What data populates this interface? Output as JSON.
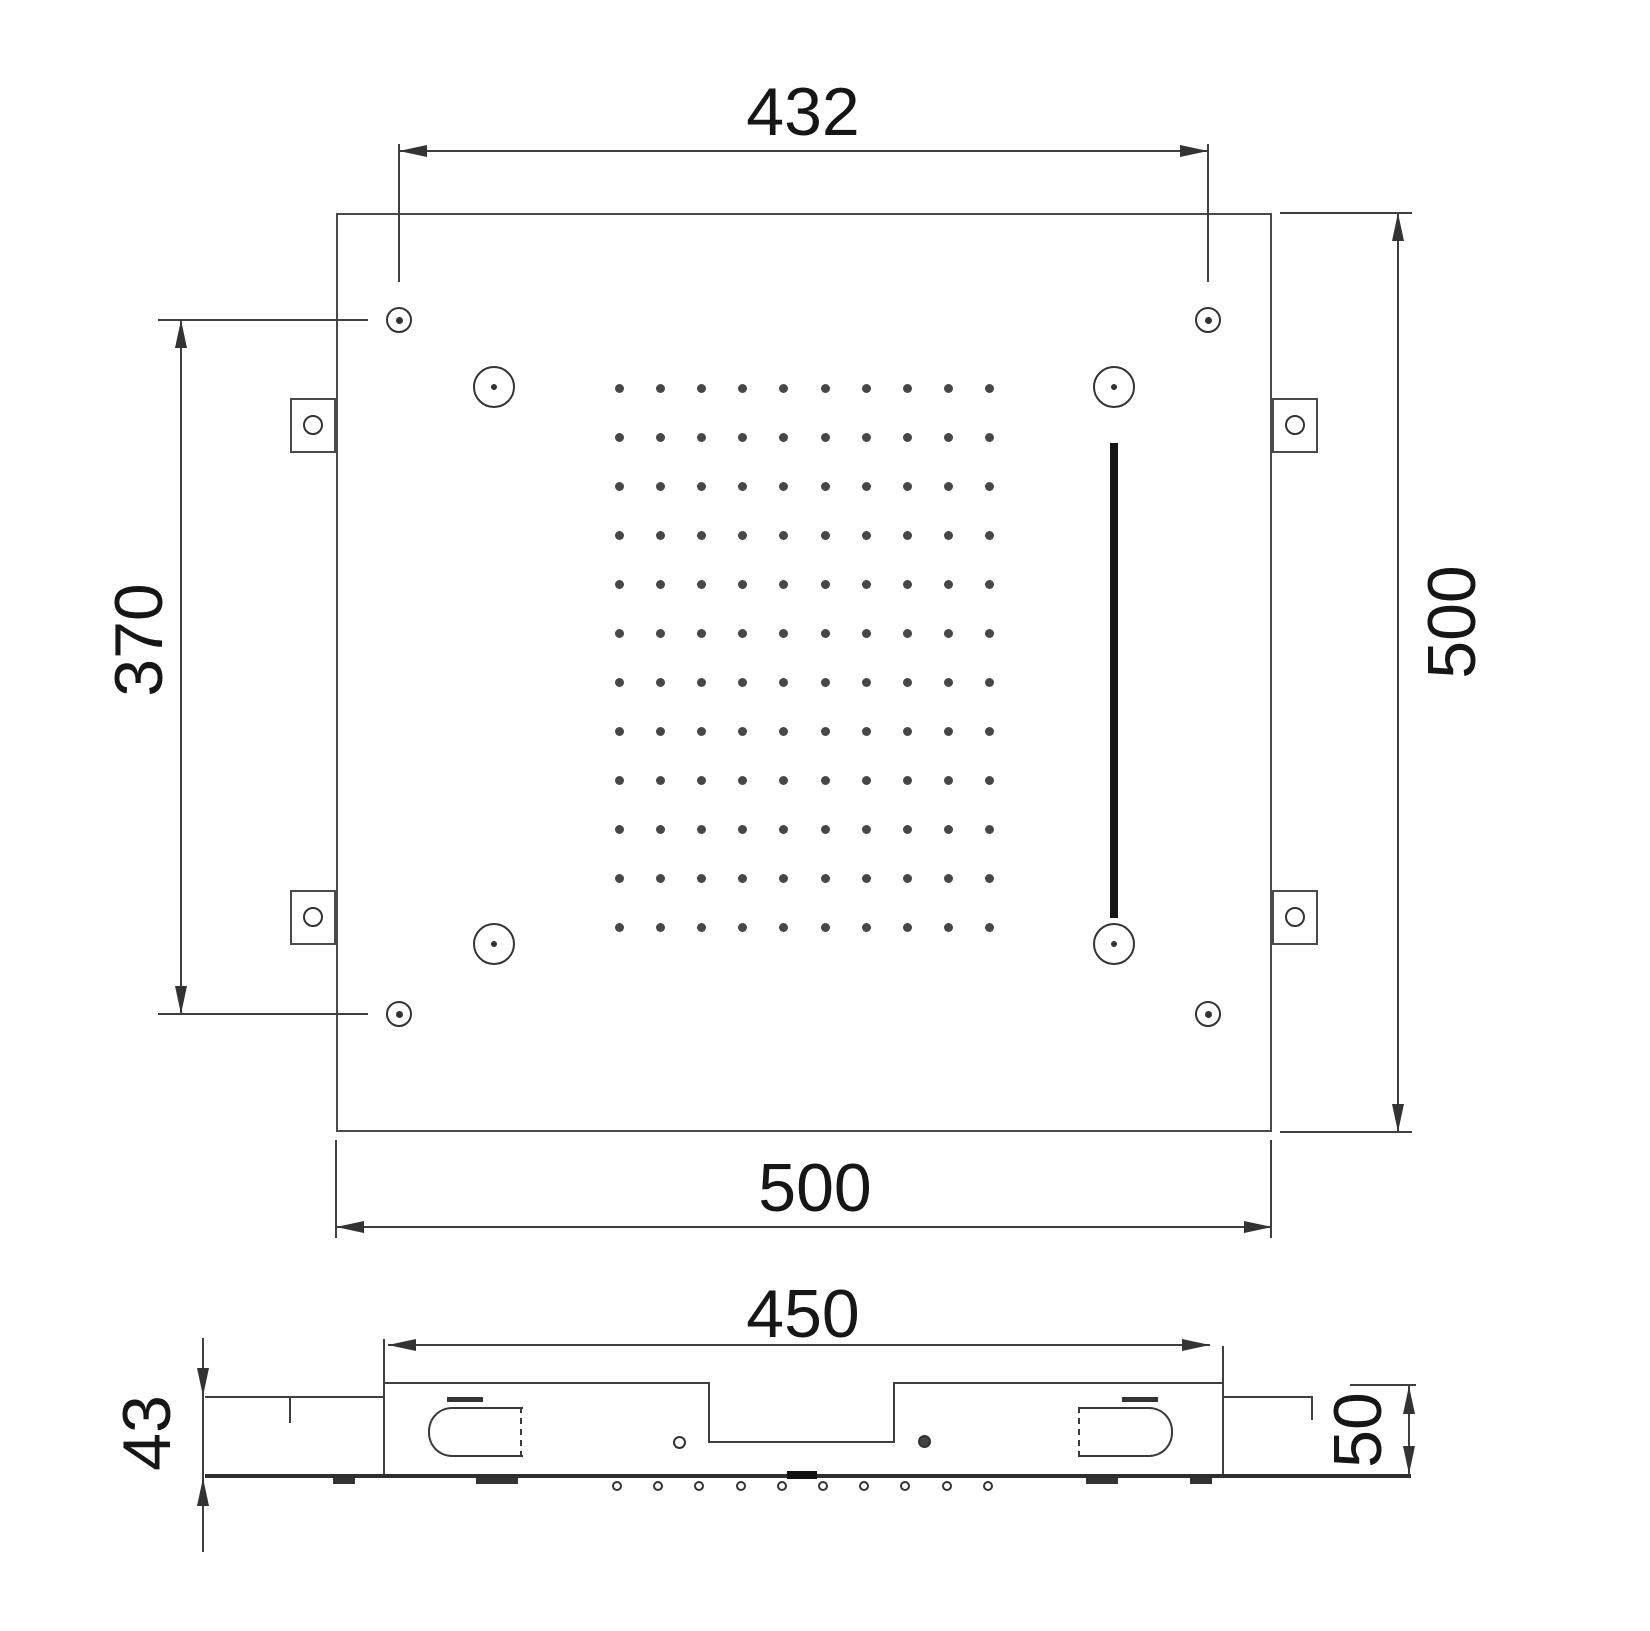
{
  "labels": {
    "plan_top_width": "432",
    "plan_left_height": "370",
    "plan_right_height": "500",
    "plan_bottom_width": "500",
    "section_width": "450",
    "section_left_depth": "43",
    "section_right_depth": "50"
  },
  "spray_grid": {
    "cols": 10,
    "rows": 12,
    "start_x": 619,
    "start_y": 388,
    "step_x": 41.2,
    "step_y": 49,
    "dot_size": 9
  },
  "section_nozzles": {
    "count": 10,
    "start_x": 617,
    "step_x": 41.2,
    "y": 1481,
    "size": 10
  },
  "colors": {
    "line": "#3f3f3f",
    "text": "#161616",
    "accent_bar": "#161616",
    "background": "#ffffff"
  }
}
